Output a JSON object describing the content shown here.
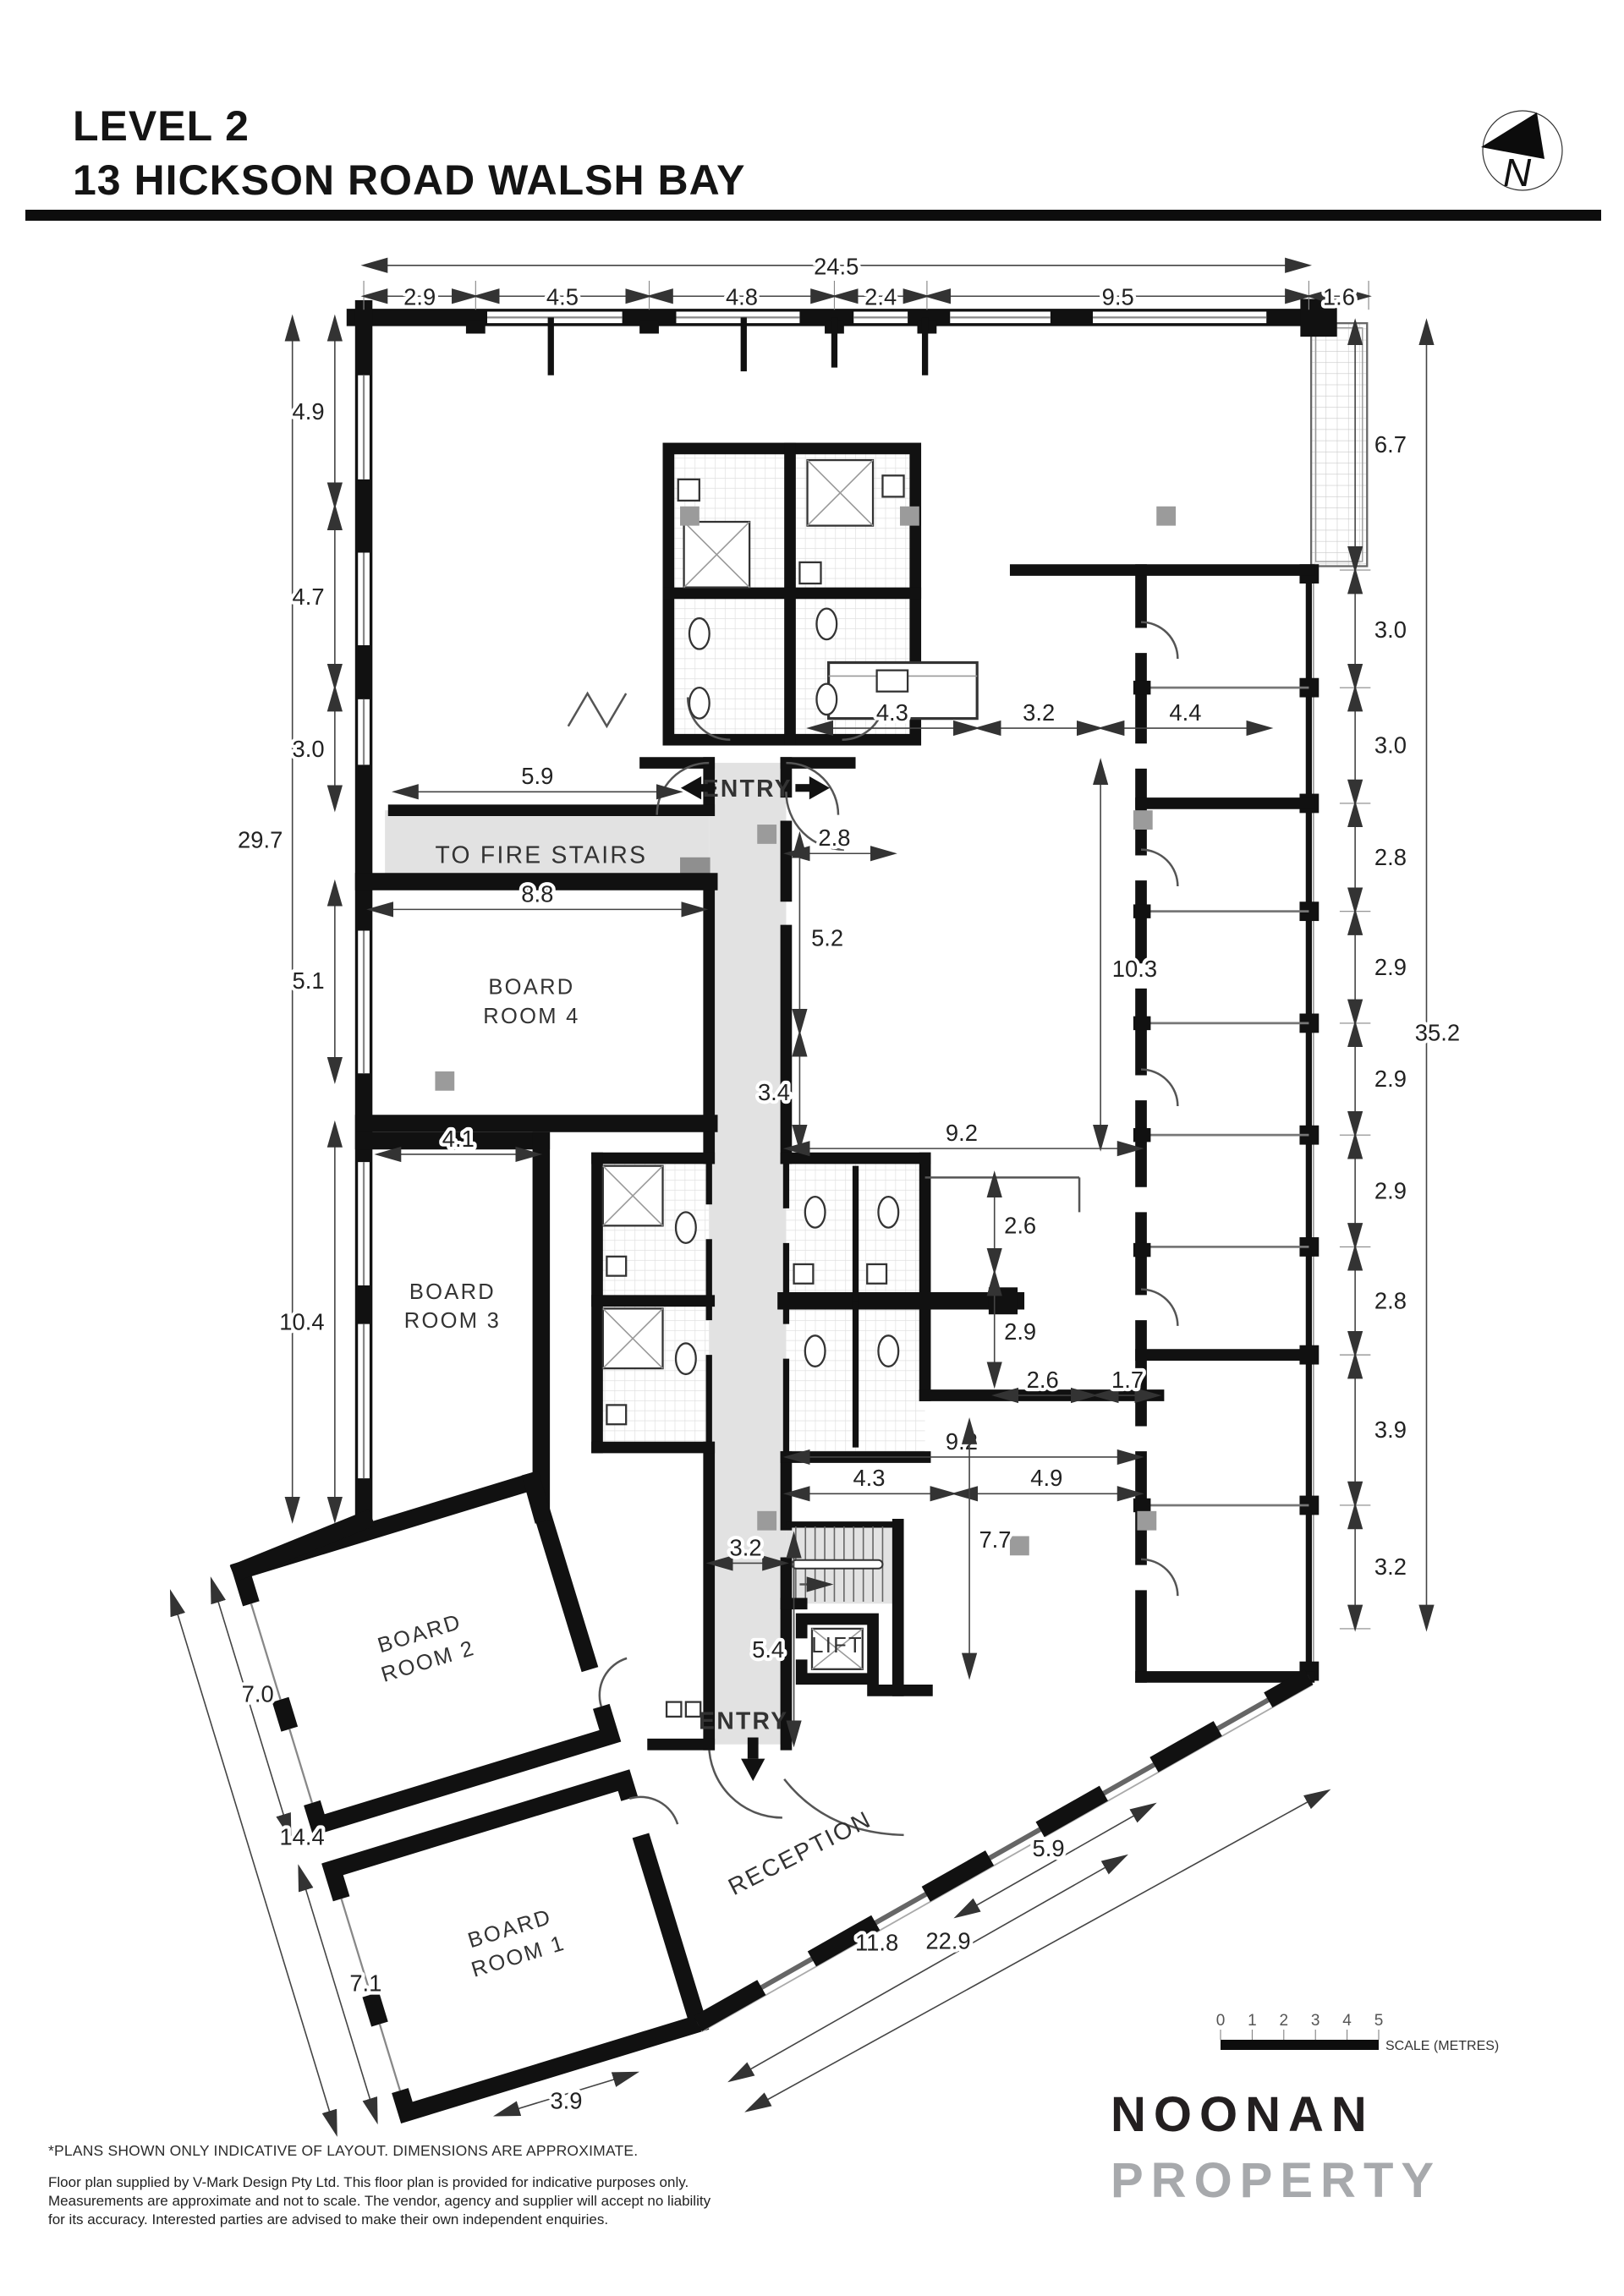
{
  "header": {
    "title_line1": "LEVEL 2",
    "title_line2": "13 HICKSON ROAD WALSH BAY"
  },
  "north": {
    "label": "N"
  },
  "plan": {
    "rooms": {
      "board_room_4": {
        "line1": "BOARD",
        "line2": "ROOM 4"
      },
      "board_room_3": {
        "line1": "BOARD",
        "line2": "ROOM 3"
      },
      "board_room_2": {
        "line1": "BOARD",
        "line2": "ROOM 2"
      },
      "board_room_1": {
        "line1": "BOARD",
        "line2": "ROOM 1"
      },
      "lift": "LIFT",
      "reception": "RECEPTION"
    },
    "labels": {
      "to_fire_stairs": "TO FIRE STAIRS",
      "entry_top": "ENTRY",
      "entry_bottom": "ENTRY"
    },
    "dims": {
      "top_overall": "24.5",
      "top_seg1": "2.9",
      "top_seg2": "4.5",
      "top_seg3": "4.8",
      "top_seg4": "2.4",
      "top_seg5": "9.5",
      "balcony": "1.6",
      "left_seg1": "4.9",
      "left_seg2": "4.7",
      "left_seg3": "3.0",
      "left_overall": "29.7",
      "left_seg4": "5.1",
      "left_seg5": "10.4",
      "right_seg1": "6.7",
      "right_seg2": "3.0",
      "right_seg3": "3.0",
      "right_seg4": "2.8",
      "right_seg5": "2.9",
      "right_overall": "35.2",
      "right_seg6": "2.9",
      "right_seg7": "2.9",
      "right_seg8": "2.8",
      "right_seg9": "3.9",
      "right_seg10": "3.2",
      "fire": "5.9",
      "br4_w": "8.8",
      "br3_w": "4.1",
      "hall_w": "2.8",
      "hall_h": "5.2",
      "hall_h2": "3.4",
      "open_h": "10.3",
      "mid1": "4.3",
      "mid2": "3.2",
      "mid3": "4.4",
      "wc_top": "9.2",
      "wc1": "2.6",
      "wc2": "2.9",
      "wc3": "2.6",
      "wc4": "1.7",
      "wc_bottom": "9.2",
      "wc5": "4.3",
      "wc6": "4.9",
      "stair_h": "7.7",
      "stair_w": "3.2",
      "lobby_h": "5.4",
      "tilt1": "7.0",
      "tilt_overall": "14.4",
      "tilt2": "7.1",
      "bottom_w": "3.9",
      "rec1": "11.8",
      "rec_overall": "22.9",
      "diag": "5.9"
    }
  },
  "scale_bar": {
    "ticks": [
      "0",
      "1",
      "2",
      "3",
      "4",
      "5"
    ],
    "label": "SCALE (METRES)"
  },
  "logo": {
    "line1": "NOONAN",
    "line2": "PROPERTY"
  },
  "footer": {
    "note": "*PLANS SHOWN ONLY INDICATIVE OF LAYOUT. DIMENSIONS ARE APPROXIMATE.",
    "line1": "Floor plan supplied by V-Mark Design Pty Ltd. This floor plan is provided for indicative purposes only.",
    "line2": "Measurements are approximate and not to scale. The vendor, agency and supplier will accept no liability",
    "line3": "for its accuracy. Interested parties are advised to make their own independent enquiries."
  },
  "colors": {
    "corridor": "#e2e2e2",
    "column_gray": "#9b9b9b",
    "logo_gray": "#a7a9ac",
    "wall": "#111111"
  }
}
